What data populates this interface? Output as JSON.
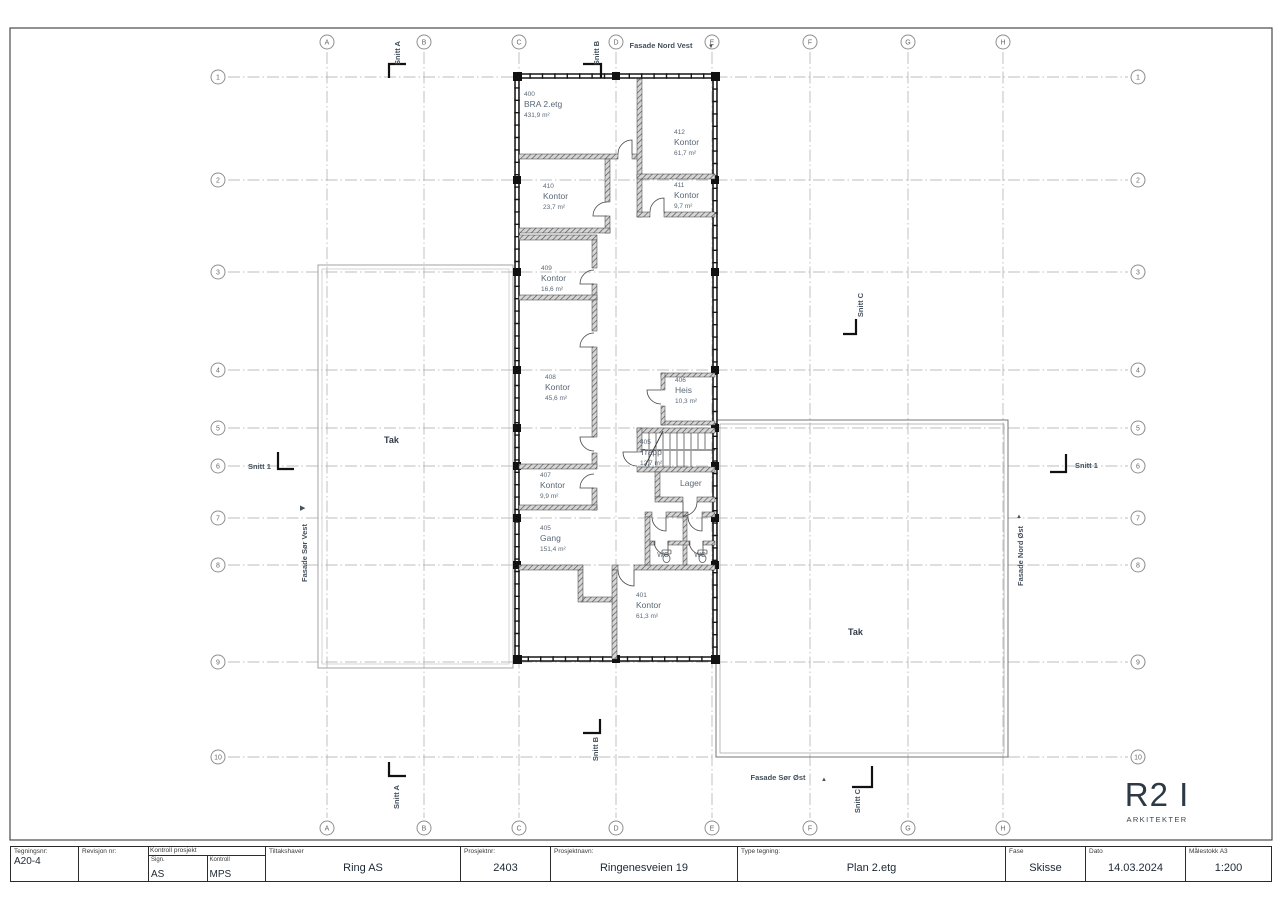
{
  "plan": {
    "grid_columns": [
      {
        "label": "A",
        "x": 327
      },
      {
        "label": "B",
        "x": 424
      },
      {
        "label": "C",
        "x": 519
      },
      {
        "label": "D",
        "x": 616
      },
      {
        "label": "E",
        "x": 712
      },
      {
        "label": "F",
        "x": 810
      },
      {
        "label": "G",
        "x": 908
      },
      {
        "label": "H",
        "x": 1003
      }
    ],
    "grid_rows": [
      {
        "label": "1",
        "y": 77
      },
      {
        "label": "2",
        "y": 180
      },
      {
        "label": "3",
        "y": 272
      },
      {
        "label": "4",
        "y": 370
      },
      {
        "label": "5",
        "y": 428
      },
      {
        "label": "6",
        "y": 466
      },
      {
        "label": "7",
        "y": 518
      },
      {
        "label": "8",
        "y": 565
      },
      {
        "label": "9",
        "y": 662
      },
      {
        "label": "10",
        "y": 757
      }
    ],
    "rooms": [
      {
        "number": "400",
        "name": "BRA 2.etg",
        "area": "431,9 m²",
        "x": 524,
        "y": 96
      },
      {
        "number": "412",
        "name": "Kontor",
        "area": "61,7 m²",
        "x": 674,
        "y": 134
      },
      {
        "number": "410",
        "name": "Kontor",
        "area": "23,7 m²",
        "x": 543,
        "y": 188
      },
      {
        "number": "411",
        "name": "Kontor",
        "area": "9,7 m²",
        "x": 674,
        "y": 187
      },
      {
        "number": "409",
        "name": "Kontor",
        "area": "16,6 m²",
        "x": 541,
        "y": 270
      },
      {
        "number": "408",
        "name": "Kontor",
        "area": "45,6 m²",
        "x": 545,
        "y": 379
      },
      {
        "number": "406",
        "name": "Heis",
        "area": "10,3 m²",
        "x": 675,
        "y": 382
      },
      {
        "number": "405",
        "name": "Trapp",
        "area": "12,7 m²",
        "x": 640,
        "y": 444
      },
      {
        "number": "407",
        "name": "Kontor",
        "area": "9,9 m²",
        "x": 540,
        "y": 477
      },
      {
        "number": "405",
        "name": "Gang",
        "area": "151,4 m²",
        "x": 540,
        "y": 530
      },
      {
        "number": "401",
        "name": "Kontor",
        "area": "61,3 m²",
        "x": 636,
        "y": 597
      }
    ],
    "labels": [
      {
        "text": "Lager",
        "x": 680,
        "y": 486,
        "size": 8.5,
        "color": "#5a6877"
      },
      {
        "text": "WC",
        "x": 663,
        "y": 557,
        "size": 7,
        "anchor": "middle",
        "color": "#5a6877"
      },
      {
        "text": "WC",
        "x": 700,
        "y": 557,
        "size": 7,
        "anchor": "middle",
        "color": "#5a6877"
      },
      {
        "text": "Tak",
        "x": 384,
        "y": 443,
        "size": 9,
        "bold": true,
        "color": "#2f3b46"
      },
      {
        "text": "Tak",
        "x": 848,
        "y": 635,
        "size": 9,
        "bold": true,
        "color": "#2f3b46"
      },
      {
        "text": "Snitt A",
        "x": 400,
        "y": 53,
        "rot": -90,
        "anchor": "middle",
        "bold": true
      },
      {
        "text": "Snitt B",
        "x": 599,
        "y": 53,
        "rot": -90,
        "anchor": "middle",
        "bold": true
      },
      {
        "text": "Snitt C",
        "x": 863,
        "y": 305,
        "rot": -90,
        "anchor": "middle",
        "bold": true
      },
      {
        "text": "Snitt A",
        "x": 399,
        "y": 797,
        "rot": -90,
        "anchor": "middle",
        "bold": true
      },
      {
        "text": "Snitt B",
        "x": 598,
        "y": 749,
        "rot": -90,
        "anchor": "middle",
        "bold": true
      },
      {
        "text": "Snitt C",
        "x": 860,
        "y": 801,
        "rot": -90,
        "anchor": "middle",
        "bold": true
      },
      {
        "text": "Snitt 1",
        "x": 248,
        "y": 469,
        "bold": true
      },
      {
        "text": "Snitt 1",
        "x": 1075,
        "y": 468,
        "bold": true
      },
      {
        "text": "Fasade Nord Vest",
        "x": 661,
        "y": 48,
        "anchor": "middle",
        "bold": true
      },
      {
        "text": "▼",
        "x": 708,
        "y": 48,
        "size": 6
      },
      {
        "text": "Fasade Sør Øst",
        "x": 778,
        "y": 780,
        "anchor": "middle",
        "bold": true
      },
      {
        "text": "▲",
        "x": 821,
        "y": 781,
        "size": 6
      },
      {
        "text": "Fasade Sør Vest",
        "x": 307,
        "y": 553,
        "rot": -90,
        "anchor": "middle",
        "bold": true
      },
      {
        "text": "▶",
        "x": 300,
        "y": 510,
        "size": 7
      },
      {
        "text": "Fasade Nord Øst",
        "x": 1023,
        "y": 556,
        "rot": -90,
        "anchor": "middle",
        "bold": true
      },
      {
        "text": "▲",
        "x": 1016,
        "y": 518,
        "size": 6
      }
    ]
  },
  "logo": {
    "title": "R2 I",
    "subtitle": "ARKITEKTER"
  },
  "title_block": {
    "tegningsnr": {
      "label": "Tegningsnr:",
      "value": "A20-4"
    },
    "revisjon": {
      "label": "Revisjon nr:",
      "value": ""
    },
    "kontroll": {
      "label": "Kontroll prosjekt",
      "sign_label": "Sign.",
      "sign_value": "AS",
      "kontroll_label": "Kontroll",
      "kontroll_value": "MPS"
    },
    "tiltakshaver": {
      "label": "Tiltakshaver",
      "value": "Ring AS"
    },
    "prosjektnr": {
      "label": "Prosjektnr:",
      "value": "2403"
    },
    "prosjektnavn": {
      "label": "Prosjektnavn:",
      "value": "Ringenesveien 19"
    },
    "type_tegning": {
      "label": "Type tegning:",
      "value": "Plan 2.etg"
    },
    "fase": {
      "label": "Fase",
      "value": "Skisse"
    },
    "dato": {
      "label": "Dato",
      "value": "14.03.2024"
    },
    "malestokk": {
      "label": "Målestokk A3",
      "value": "1:200"
    }
  }
}
